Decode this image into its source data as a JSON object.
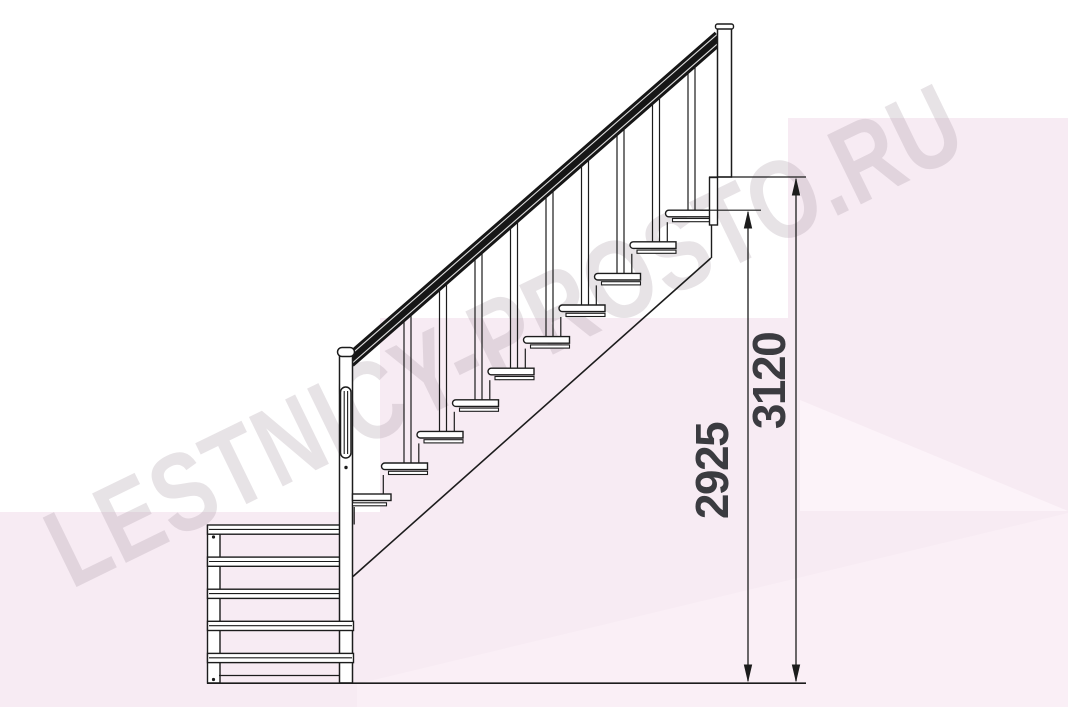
{
  "watermark": {
    "text": "LESTNICY-PROSTO.RU"
  },
  "diagram": {
    "type": "staircase-side-elevation",
    "dimensions": {
      "height_to_top_tread": "2925",
      "height_to_upper_floor": "3120"
    },
    "counts": {
      "main_flight_treads": 10,
      "lower_flight_treads": 5,
      "balusters": 9
    },
    "colors": {
      "line": "#1c1c1c",
      "handrail": "#161616",
      "dimension_text": "#3b3b40",
      "background_pink": "#f7ebf3",
      "background_pink_light": "#faeff6",
      "background_pink_lighter": "#fcf3f9",
      "watermark": "rgba(168,155,164,0.28)"
    }
  }
}
